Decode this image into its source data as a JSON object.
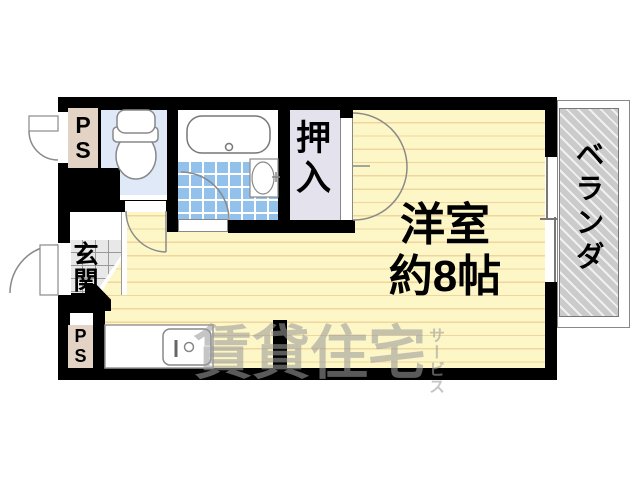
{
  "floorplan": {
    "main_room": {
      "name": "洋室",
      "size": "約8帖"
    },
    "closet": {
      "label": "押入"
    },
    "entrance": {
      "label": "玄関"
    },
    "balcony": {
      "label": "ベランダ"
    },
    "pipe_space_top": {
      "line1": "P",
      "line2": "S"
    },
    "pipe_space_bottom": {
      "line1": "P",
      "line2": "S"
    },
    "watermark": {
      "main": "賃貸住宅",
      "sub": "サービス"
    },
    "colors": {
      "wall": "#000000",
      "floor": "#fdf6c6",
      "floor_line": "#f0d59e",
      "bath_tile_blue": "#92c1ec",
      "toilet_room_blue": "#dfe9f7",
      "closet_fill": "#e4e2ec",
      "pipe_space_beige": "#e2d3c5",
      "genkan_tile_gray": "#e8e8e8",
      "balcony_hatch_gray": "#cbcbcb",
      "watermark_gray": "#9b9b9b"
    }
  }
}
